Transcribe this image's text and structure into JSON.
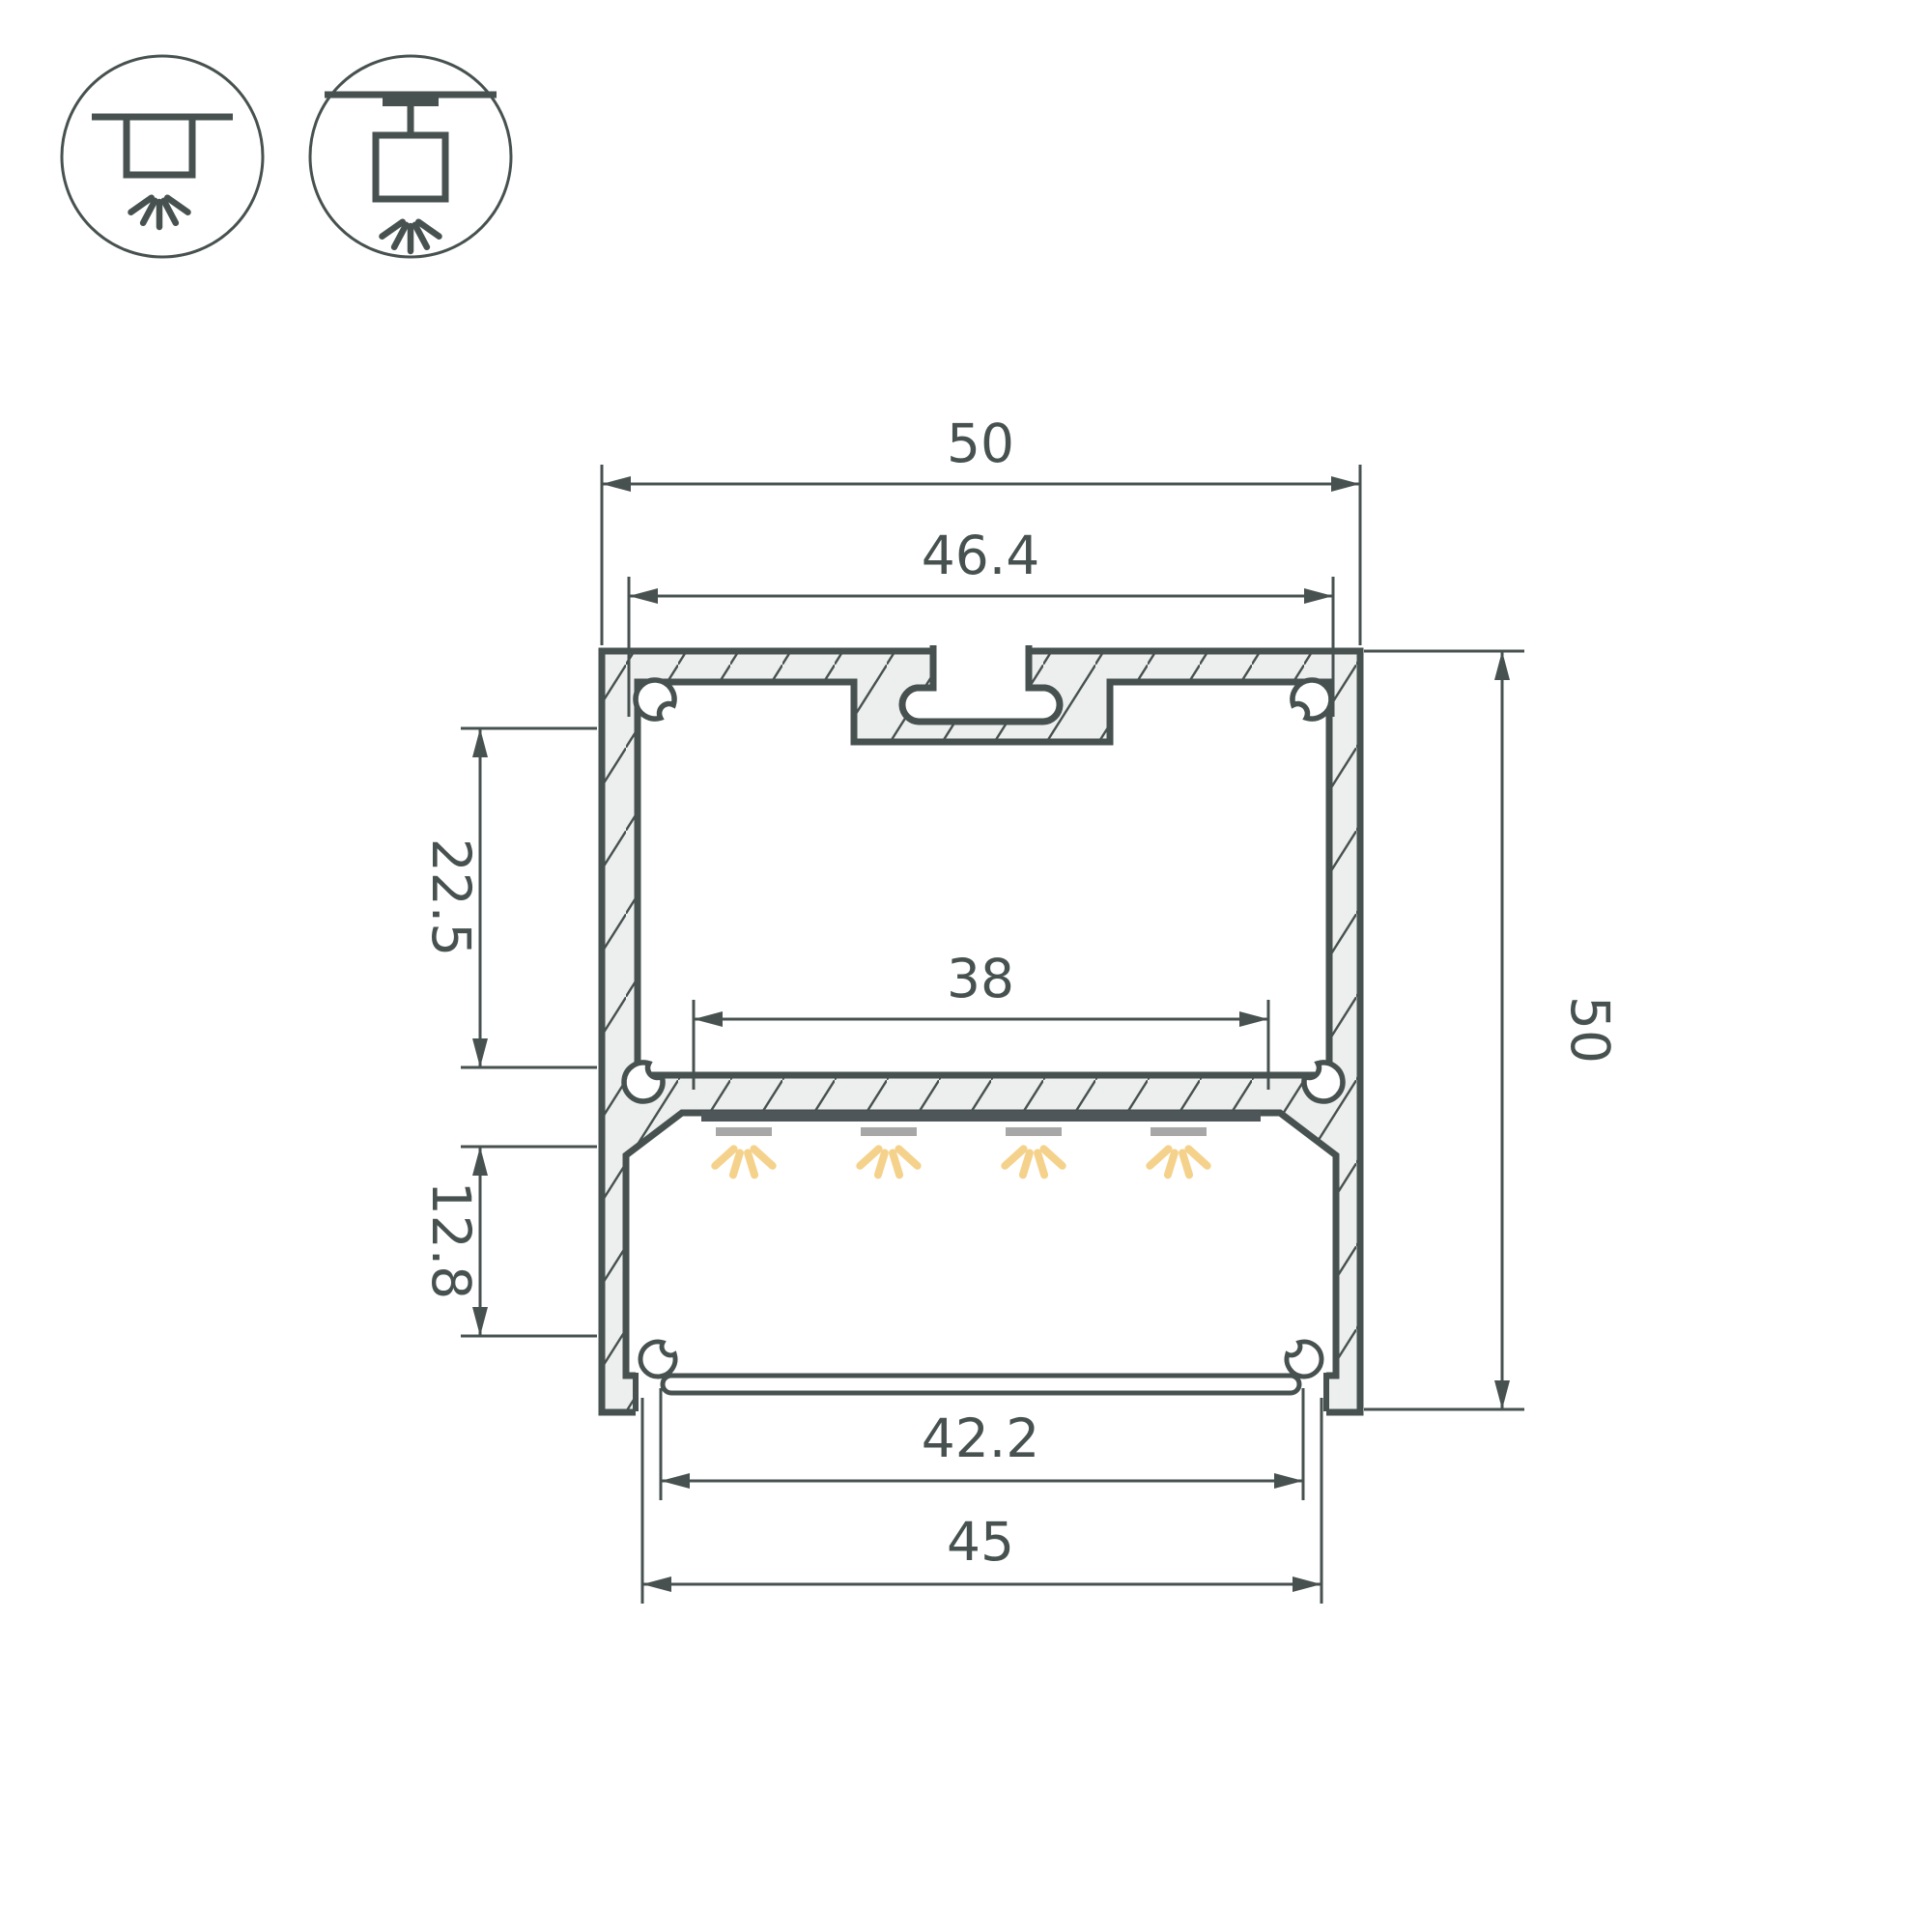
{
  "drawing": {
    "subject": "LED aluminium profile cross-section with dimensions",
    "dims": {
      "width_overall": "50",
      "width_inner_top": "46.4",
      "height_upper": "22.5",
      "width_led_window": "38",
      "height_lower": "12.8",
      "width_diffuser": "42.2",
      "width_bottom": "45",
      "height_overall": "50"
    },
    "icons": [
      {
        "name": "surface-mount-icon",
        "meaning": "surface ceiling mounting, light directed down"
      },
      {
        "name": "pendant-mount-icon",
        "meaning": "suspended / pendant mounting, light directed down"
      }
    ]
  },
  "colors": {
    "line": "#475250",
    "fill": "#edefee",
    "led_pcb": "#4e565a",
    "led_module": "#a7a7a7",
    "light_ray": "#f5d28c",
    "bg": "#ffffff"
  }
}
